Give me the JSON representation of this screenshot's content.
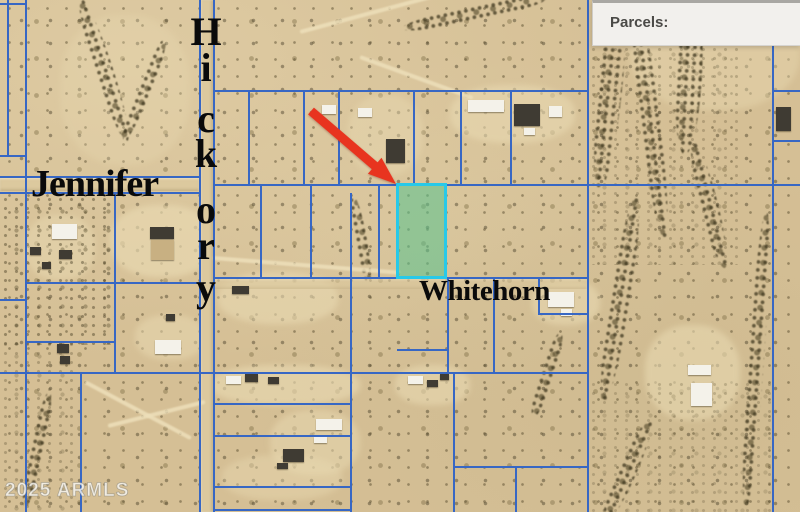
{
  "panel": {
    "label": "Parcels:"
  },
  "map": {
    "street_labels": {
      "jennifer": "Jennifer",
      "hickory": "Hickory",
      "whitehorn": "Whitehorn"
    },
    "watermark": "2025 ARMLS"
  },
  "colors": {
    "parcel_line": "#3767c4",
    "highlight_fill": "rgba(88,195,142,0.55)",
    "highlight_border": "#27c9e9",
    "arrow_red": "#e8341f",
    "sand_base": "#d5bf95",
    "panel_bg": "#f2f0ed",
    "panel_text": "#4b4a47",
    "street_label_color": "#0a0a0a",
    "watermark_color": "#f0efec"
  }
}
